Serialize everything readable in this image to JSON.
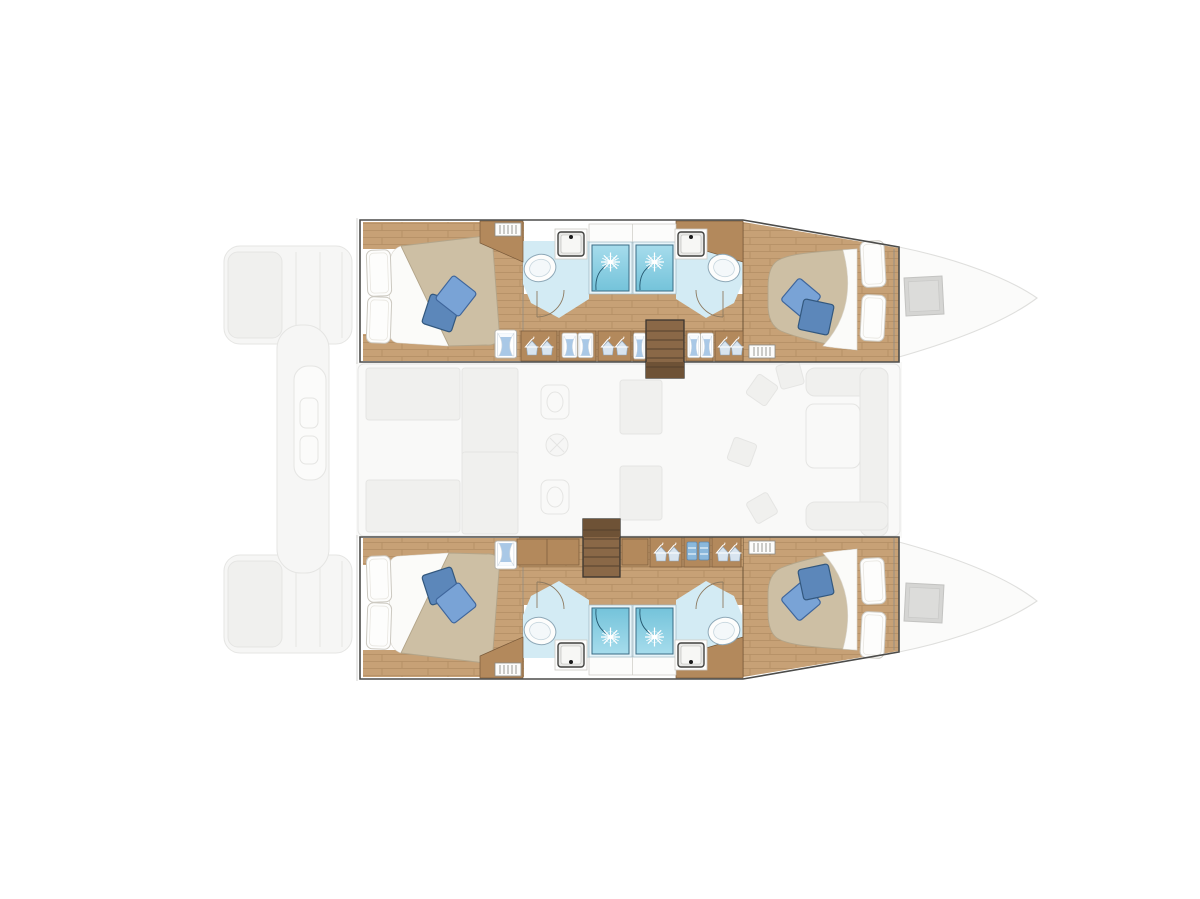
{
  "meta": {
    "title": "Catamaran yacht deck plan",
    "aria_label": "Top-down floor plan of a sailing catamaran with four double cabins and four bathrooms; the central saloon deck is shown ghosted",
    "view": "top-down-floor-plan",
    "background": "#ffffff"
  },
  "palette": {
    "bg": "#ffffff",
    "hull_outline": "#4c4c4a",
    "hull_outline_soft": "#c8c8c5",
    "wood_floor": "#c7a176",
    "wood_seam": "#a07c54",
    "wood_cabinet": "#b3895c",
    "wood_edge": "#7a5a3a",
    "wood_stairs": "#8a6847",
    "wood_stairs_dark": "#6e5236",
    "wood_tread": "#54402c",
    "mattress": "#cdbfa4",
    "mattress_edge": "#b3a58a",
    "sheet": "#fbfbf9",
    "pillow_white": "#fdfdfc",
    "cushion_light": "#79a3d6",
    "cushion_light_edge": "#3f669c",
    "cushion_dark": "#5c87ba",
    "cushion_dark_edge": "#33587e",
    "bath_floor": "#d3ebf4",
    "shower_top": "#a6dcec",
    "shower_bottom": "#74c3da",
    "shower_frame": "#e8f5fa",
    "shower_edge": "#3a6b84",
    "fixture": "#fdfdfc",
    "fixture_edge": "#8fa9b8",
    "basin_edge": "#41413f",
    "window_glass": "#a9c8e6",
    "window_frame": "#ffffff",
    "ghost_fill": "#f6f6f5",
    "ghost_fill2": "#f0f0ee",
    "ghost_line": "#e4e4e2",
    "hatch_fill": "#d3d3d1",
    "hatch_edge": "#c0c0be"
  },
  "vessel": {
    "type": "catamaran",
    "orientation": "bows to the right, sterns to the left",
    "hulls": [
      {
        "id": "port-hull",
        "position": "top",
        "aria": "Port hull: aft double cabin, two bathrooms with twin shower stalls, wardrobe corridor, forward double cabin, companionway stairs",
        "cabins": [
          "aft double berth",
          "forward double berth"
        ]
      },
      {
        "id": "starboard-hull",
        "position": "bottom",
        "aria": "Starboard hull: aft double cabin, two bathrooms with twin shower stalls, wardrobe corridor, forward double cabin, companionway stairs",
        "cabins": [
          "aft double berth",
          "forward double berth"
        ]
      }
    ],
    "bridgedeck": {
      "rendered": "ghosted",
      "features": [
        "saloon",
        "galley with sink and stove",
        "dinette sofa and table",
        "aft cockpit lounge",
        "stern platforms",
        "foredeck with hatches"
      ]
    },
    "counts": {
      "cabins": 4,
      "double_berths": 4,
      "bathrooms": 4,
      "shower_stalls": 4,
      "toilets": 4,
      "washbasins": 4,
      "companionway_staircases": 2,
      "deck_hatches": 2,
      "blue_cushions": 8,
      "white_pillows": 8
    }
  }
}
